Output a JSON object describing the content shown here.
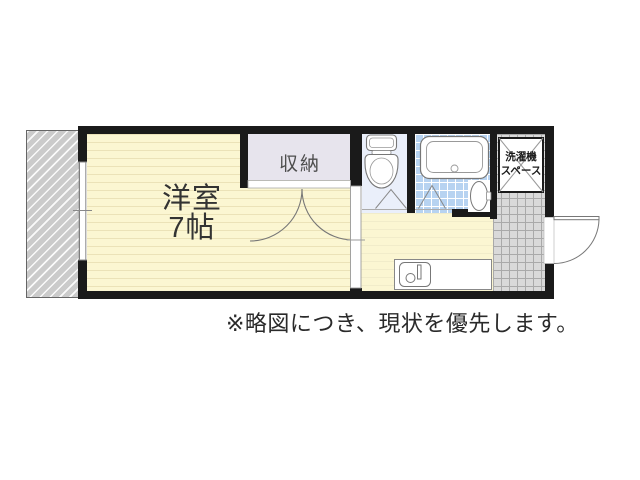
{
  "plan": {
    "rooms": {
      "main_room": {
        "label_line1": "洋室",
        "label_line2": "7帖"
      },
      "closet": {
        "label": "収納"
      },
      "washer_space": {
        "label_line1": "洗濯機",
        "label_line2": "スペース"
      }
    },
    "note": "※略図につき、現状を優先します。",
    "fixture_icons": [
      "toilet-icon",
      "bathtub-icon",
      "wash-basin-icon",
      "kitchen-sink-icon",
      "entrance-door-swing",
      "closet-double-door-swing",
      "sliding-door",
      "sliding-window",
      "folding-door-marker",
      "washer-space-cross",
      "balcony-hatch"
    ],
    "colors": {
      "wall": "#1a1a1a",
      "room_yellow": "#fbf6d2",
      "floor_stripe": "#ebe2b8",
      "closet_fill": "#e7e4ed",
      "toilet_fill": "#eaeffa",
      "bath_tile": "#b7d3f1",
      "entrance_tile": "#d9d9d9",
      "tile_grid": "#a9a9a9",
      "balcony_fill": "#cbcbcb",
      "outline": "#777777",
      "text": "#333333"
    }
  }
}
